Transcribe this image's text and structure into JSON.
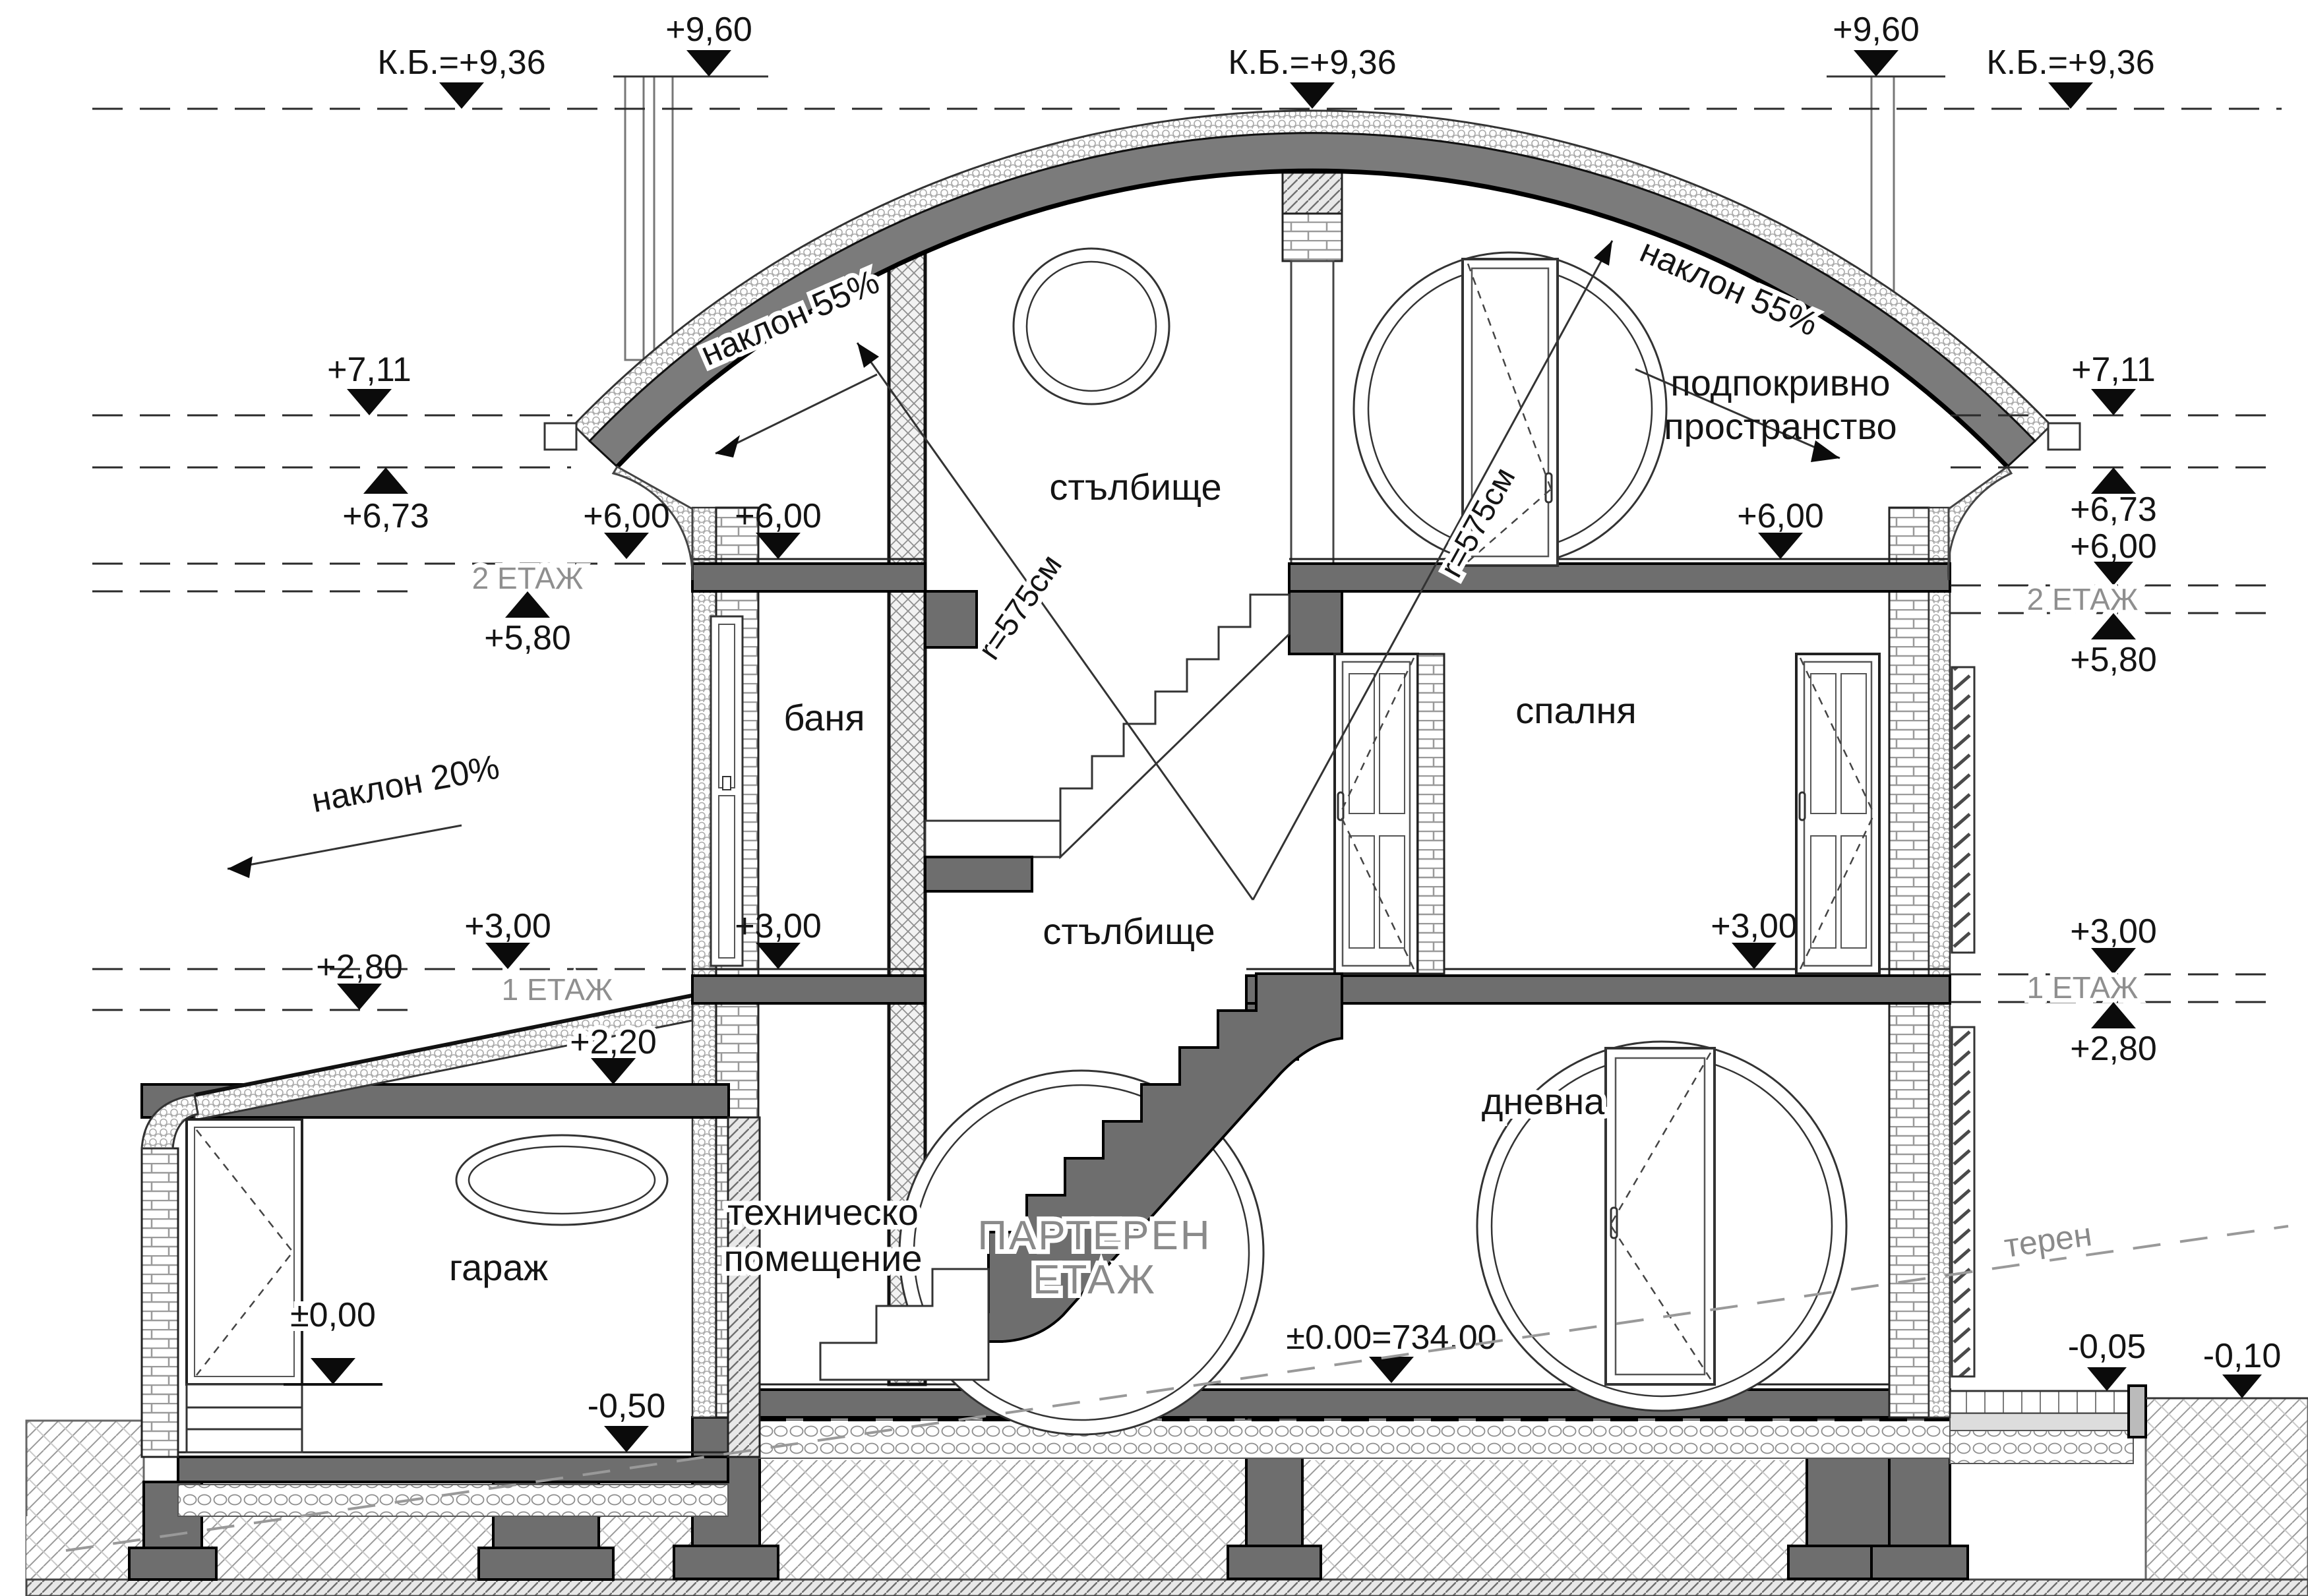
{
  "drawing": {
    "kind": "architectural-section",
    "language": "bg"
  },
  "levels": {
    "p960": "+9,60",
    "kb": "К.Б.=+9,36",
    "p711": "+7,11",
    "p673": "+6,73",
    "p600": "+6,00",
    "p580": "+5,80",
    "p300": "+3,00",
    "p280": "+2,80",
    "p220": "+2,20",
    "zero": "±0,00",
    "zeroAbs": "±0.00=734.00",
    "m005": "-0,05",
    "m010": "-0,10",
    "m050": "-0,50"
  },
  "floors": {
    "f2": "2 ЕТАЖ",
    "f1": "1 ЕТАЖ",
    "ground1": "ПАРТЕРЕН",
    "ground2": "ЕТАЖ"
  },
  "rooms": {
    "stairs": "стълбище",
    "bath": "баня",
    "bedroom": "спалня",
    "attic1": "подпокривно",
    "attic2": "пространство",
    "garage": "гараж",
    "tech1": "техническо",
    "tech2": "помещение",
    "living": "дневна"
  },
  "slopes": {
    "roof": "наклон 55%",
    "garageRoof": "наклон 20%"
  },
  "dims": {
    "radius": "r=575см"
  },
  "site": {
    "terrain": "терен"
  },
  "colors": {
    "concrete": "#6e6e6e",
    "line": "#141414",
    "grayText": "#8a8a8a",
    "background": "#ffffff"
  }
}
